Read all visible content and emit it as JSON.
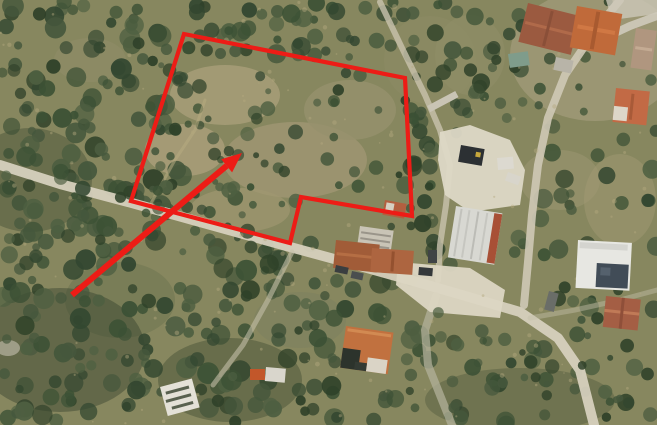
{
  "image": {
    "width": 657,
    "height": 425,
    "kind": "satellite-aerial-photo",
    "description": "Aerial satellite photograph of an olive-grove hillside at a village edge, with dirt roads, farm buildings and a warehouse; a red outline marks a land parcel and a red arrow points into it"
  },
  "annotation": {
    "color": "#ed1c16",
    "parcel_outline": {
      "points": [
        [
          184,
          34
        ],
        [
          405,
          78
        ],
        [
          412,
          216
        ],
        [
          301,
          197
        ],
        [
          290,
          243
        ],
        [
          131,
          201
        ]
      ],
      "stroke_width": 4.2
    },
    "arrow": {
      "tail": [
        72,
        295
      ],
      "tip": [
        242,
        153
      ],
      "shaft_width": 6,
      "head_length": 20,
      "head_half_width": 8.5
    }
  },
  "terrain": {
    "base": "#87875f",
    "washes": [
      [
        595,
        55,
        85,
        66,
        "#aca384",
        0.55
      ],
      [
        430,
        60,
        46,
        44,
        "#8e8c66",
        0.5
      ],
      [
        120,
        300,
        55,
        38,
        "#6f7752",
        0.6
      ],
      [
        520,
        400,
        95,
        32,
        "#39462f",
        0.3
      ],
      [
        60,
        350,
        85,
        62,
        "#2c3a27",
        0.4
      ],
      [
        30,
        180,
        62,
        52,
        "#31402b",
        0.35
      ],
      [
        230,
        380,
        72,
        42,
        "#2e3c28",
        0.35
      ],
      [
        8,
        348,
        12,
        8,
        "#c7c2b0",
        0.6
      ]
    ],
    "patches": [
      [
        225,
        95,
        55,
        30,
        "#a59c77",
        0.9
      ],
      [
        295,
        160,
        72,
        38,
        "#9f9572",
        0.85
      ],
      [
        185,
        150,
        40,
        26,
        "#ab9f7a",
        0.8
      ],
      [
        350,
        110,
        46,
        30,
        "#96916d",
        0.8
      ],
      [
        240,
        210,
        50,
        22,
        "#a09770",
        0.7
      ],
      [
        90,
        60,
        36,
        22,
        "#8f8c68",
        0.6
      ],
      [
        560,
        180,
        40,
        30,
        "#99956f",
        0.6
      ],
      [
        620,
        200,
        36,
        46,
        "#a29a74",
        0.5
      ],
      [
        300,
        320,
        46,
        28,
        "#7d815f",
        0.6
      ],
      [
        470,
        55,
        35,
        40,
        "#908d68",
        0.6
      ]
    ]
  },
  "trees": {
    "seed": 1337,
    "colors": [
      "#3c5135",
      "#334730",
      "#45573c",
      "#2f4129",
      "#4e5f41"
    ],
    "regions": [
      [
        0,
        0,
        195,
        425,
        210,
        4,
        11
      ],
      [
        180,
        0,
        240,
        55,
        45,
        4,
        10
      ],
      [
        150,
        45,
        265,
        200,
        62,
        3,
        8
      ],
      [
        185,
        240,
        240,
        185,
        125,
        4,
        11
      ],
      [
        405,
        125,
        252,
        300,
        135,
        4,
        10
      ],
      [
        408,
        0,
        115,
        135,
        42,
        4,
        9
      ],
      [
        515,
        0,
        142,
        135,
        18,
        3,
        6
      ]
    ],
    "overhang_regions": [
      [
        0,
        150,
        300,
        115,
        45,
        3,
        8
      ],
      [
        410,
        300,
        240,
        120,
        30,
        3,
        8
      ]
    ],
    "exclusions": [
      [
        438,
        122,
        100,
        100
      ],
      [
        392,
        255,
        155,
        70
      ],
      [
        570,
        232,
        80,
        65
      ],
      [
        448,
        198,
        62,
        68
      ],
      [
        328,
        232,
        96,
        48
      ],
      [
        525,
        0,
        132,
        50
      ],
      [
        336,
        318,
        66,
        60
      ],
      [
        598,
        290,
        52,
        45
      ],
      [
        152,
        382,
        48,
        40
      ]
    ],
    "speckles": {
      "count": 130,
      "color": "#b3a87e",
      "opacity": 0.45
    }
  },
  "roads": [
    {
      "name": "main-road",
      "points": [
        [
          0,
          165
        ],
        [
          60,
          184
        ],
        [
          128,
          202
        ],
        [
          200,
          222
        ],
        [
          290,
          247
        ],
        [
          360,
          266
        ],
        [
          410,
          280
        ],
        [
          462,
          295
        ],
        [
          520,
          312
        ],
        [
          558,
          338
        ],
        [
          580,
          370
        ],
        [
          594,
          425
        ]
      ],
      "width": 10,
      "color": "#d6d0bd",
      "opacity": 0.95
    },
    {
      "name": "village-road",
      "points": [
        [
          620,
          0
        ],
        [
          597,
          28
        ],
        [
          565,
          75
        ],
        [
          548,
          118
        ],
        [
          538,
          165
        ],
        [
          532,
          215
        ],
        [
          528,
          262
        ],
        [
          524,
          305
        ]
      ],
      "width": 8,
      "color": "#cfc9b6",
      "opacity": 0.9
    },
    {
      "name": "yard-track",
      "points": [
        [
          380,
          2
        ],
        [
          402,
          48
        ],
        [
          425,
          95
        ],
        [
          440,
          130
        ],
        [
          450,
          165
        ],
        [
          446,
          205
        ],
        [
          440,
          245
        ],
        [
          438,
          280
        ]
      ],
      "width": 6,
      "color": "#c9c3ae",
      "opacity": 0.8
    },
    {
      "name": "south-track",
      "points": [
        [
          436,
          296
        ],
        [
          425,
          330
        ],
        [
          428,
          365
        ],
        [
          442,
          400
        ],
        [
          452,
          425
        ]
      ],
      "width": 8,
      "color": "#b2b09a",
      "opacity": 0.75
    },
    {
      "name": "southwest-track",
      "points": [
        [
          292,
          252
        ],
        [
          268,
          300
        ],
        [
          243,
          345
        ],
        [
          213,
          385
        ]
      ],
      "width": 5,
      "color": "#c4bfa9",
      "opacity": 0.6
    },
    {
      "name": "east-track",
      "points": [
        [
          530,
          318
        ],
        [
          575,
          310
        ],
        [
          620,
          300
        ],
        [
          657,
          290
        ]
      ],
      "width": 5,
      "color": "#c4bfa9",
      "opacity": 0.45
    },
    {
      "name": "top-right-road",
      "points": [
        [
          600,
          40
        ],
        [
          630,
          26
        ],
        [
          657,
          16
        ]
      ],
      "width": 8,
      "color": "#cfcabb",
      "opacity": 0.9
    },
    {
      "name": "parcel-track",
      "points": [
        [
          150,
          205
        ],
        [
          175,
          160
        ],
        [
          195,
          130
        ],
        [
          205,
          100
        ]
      ],
      "width": 3,
      "color": "#b7ab80",
      "opacity": 0.55
    }
  ],
  "pads": [
    {
      "name": "junction-pad",
      "points": [
        [
          398,
          262
        ],
        [
          470,
          268
        ],
        [
          505,
          290
        ],
        [
          500,
          318
        ],
        [
          430,
          312
        ],
        [
          396,
          285
        ]
      ],
      "color": "#dcd6c3",
      "opacity": 0.95
    },
    {
      "name": "yard-pad",
      "points": [
        [
          440,
          132
        ],
        [
          470,
          125
        ],
        [
          510,
          140
        ],
        [
          525,
          170
        ],
        [
          520,
          205
        ],
        [
          470,
          212
        ],
        [
          445,
          195
        ],
        [
          438,
          160
        ]
      ],
      "color": "#ddd8c6",
      "opacity": 0.95
    },
    {
      "name": "corner-pad",
      "points": [
        [
          606,
          0
        ],
        [
          657,
          0
        ],
        [
          657,
          14
        ],
        [
          612,
          20
        ]
      ],
      "color": "#cdc8b9",
      "opacity": 0.8
    }
  ],
  "buildings": [
    {
      "name": "village-roof-1",
      "x": 528,
      "y": 3,
      "w": 54,
      "h": 40,
      "rot": 14,
      "fill": "#9b5a40",
      "parts": [
        [
          2,
          18,
          50,
          3,
          "#b06a4a",
          1
        ],
        [
          24,
          2,
          3,
          36,
          "#8a4f38",
          1
        ]
      ]
    },
    {
      "name": "village-roof-2",
      "x": 577,
      "y": 6,
      "w": 46,
      "h": 42,
      "rot": 10,
      "fill": "#c06a3a",
      "parts": [
        [
          4,
          18,
          38,
          4,
          "#d07844",
          1
        ],
        [
          20,
          2,
          4,
          38,
          "#a85a30",
          1
        ]
      ]
    },
    {
      "name": "village-roof-3",
      "x": 636,
      "y": 28,
      "w": 21,
      "h": 40,
      "rot": 8,
      "fill": "#b0967f",
      "parts": [
        [
          2,
          18,
          17,
          3,
          "#c4ab93",
          1
        ]
      ]
    },
    {
      "name": "village-house-4",
      "x": 616,
      "y": 88,
      "w": 34,
      "h": 34,
      "rot": 6,
      "fill": "#c26a45",
      "parts": [
        [
          0,
          18,
          14,
          14,
          "#ddd6c8",
          1
        ],
        [
          16,
          4,
          3,
          26,
          "#a85a38",
          1
        ]
      ]
    },
    {
      "name": "teal-shed",
      "x": 508,
      "y": 54,
      "w": 20,
      "h": 14,
      "rot": -8,
      "fill": "#7f9c8b",
      "parts": []
    },
    {
      "name": "grey-shed",
      "x": 556,
      "y": 57,
      "w": 18,
      "h": 13,
      "rot": 12,
      "fill": "#b8b4a8",
      "parts": []
    },
    {
      "name": "retaining-wall",
      "x": 427,
      "y": 106,
      "w": 32,
      "h": 7,
      "rot": -28,
      "fill": "#c9c4b4",
      "parts": []
    },
    {
      "name": "warehouse",
      "x": 456,
      "y": 206,
      "w": 47,
      "h": 52,
      "rot": 9,
      "fill": "#d8d8d2",
      "parts": [
        [
          5,
          2,
          2,
          48,
          "#c2c2bc",
          1
        ],
        [
          13,
          2,
          2,
          48,
          "#c6c6c0",
          1
        ],
        [
          22,
          2,
          2,
          48,
          "#bcbcb6",
          1
        ],
        [
          31,
          2,
          2,
          48,
          "#c6c6c0",
          1
        ],
        [
          39,
          1,
          8,
          50,
          "#a85036",
          1
        ]
      ]
    },
    {
      "name": "farm-structure-white",
      "x": 360,
      "y": 226,
      "w": 34,
      "h": 26,
      "rot": 8,
      "fill": "#c9c4b6",
      "parts": [
        [
          2,
          5,
          30,
          2,
          "#9a958a",
          1
        ],
        [
          2,
          11,
          30,
          2,
          "#9a958a",
          1
        ],
        [
          2,
          17,
          30,
          2,
          "#9a958a",
          1
        ]
      ]
    },
    {
      "name": "farm-roof-1",
      "x": 336,
      "y": 240,
      "w": 44,
      "h": 28,
      "rot": 6,
      "fill": "#a15c38",
      "parts": [
        [
          2,
          12,
          40,
          3,
          "#b56e44",
          1
        ]
      ]
    },
    {
      "name": "farm-roof-2",
      "x": 372,
      "y": 248,
      "w": 42,
      "h": 24,
      "rot": 4,
      "fill": "#ad6540",
      "parts": [
        [
          20,
          2,
          3,
          20,
          "#94512f",
          1
        ]
      ]
    },
    {
      "name": "notch-building",
      "x": 385,
      "y": 200,
      "w": 22,
      "h": 15,
      "rot": 10,
      "fill": "#b35f3f",
      "parts": [
        [
          2,
          2,
          8,
          11,
          "#d6d0c2",
          1
        ]
      ]
    },
    {
      "name": "bottom-house",
      "x": 346,
      "y": 326,
      "w": 48,
      "h": 42,
      "rot": 8,
      "fill": "#c1713f",
      "parts": [
        [
          2,
          2,
          44,
          3,
          "#d28a52",
          1
        ],
        [
          0,
          22,
          18,
          20,
          "#2c332c",
          1
        ],
        [
          26,
          28,
          20,
          14,
          "#dad4c6",
          1
        ],
        [
          14,
          34,
          12,
          8,
          "#333a33",
          1
        ]
      ]
    },
    {
      "name": "white-flat-building",
      "x": 578,
      "y": 240,
      "w": 54,
      "h": 48,
      "rot": 3,
      "fill": "#e7e7e2",
      "parts": [
        [
          2,
          2,
          48,
          6,
          "#d4d4cf",
          1
        ],
        [
          20,
          22,
          32,
          24,
          "#414c57",
          1
        ],
        [
          24,
          26,
          10,
          8,
          "#55616d",
          1
        ]
      ]
    },
    {
      "name": "terracotta-house",
      "x": 606,
      "y": 296,
      "w": 35,
      "h": 31,
      "rot": 6,
      "fill": "#a45e44",
      "parts": [
        [
          0,
          13,
          35,
          3,
          "#c07a57",
          1
        ],
        [
          16,
          0,
          3,
          31,
          "#8f4f39",
          1
        ]
      ]
    },
    {
      "name": "white-tent",
      "x": 160,
      "y": 387,
      "w": 33,
      "h": 30,
      "rot": -15,
      "fill": "#e4e1d7",
      "parts": [
        [
          4,
          6,
          24,
          3,
          "#59614f",
          1
        ],
        [
          2,
          14,
          26,
          3,
          "#59614f",
          1
        ],
        [
          6,
          22,
          22,
          3,
          "#59614f",
          1
        ]
      ]
    }
  ],
  "vehicles": [
    {
      "name": "dark-truck-yard",
      "x": 461,
      "y": 145,
      "w": 24,
      "h": 17,
      "rot": 10,
      "fill": "#2c3033",
      "parts": [
        [
          16,
          4,
          5,
          5,
          "#c8a83c",
          1
        ]
      ]
    },
    {
      "name": "white-machine-yard",
      "x": 497,
      "y": 158,
      "w": 16,
      "h": 12,
      "rot": -5,
      "fill": "#dcd9d0",
      "parts": []
    },
    {
      "name": "white-van-yard",
      "x": 508,
      "y": 172,
      "w": 14,
      "h": 9,
      "rot": 20,
      "fill": "#d8d5cb",
      "parts": []
    },
    {
      "name": "car-on-road-1",
      "x": 336,
      "y": 265,
      "w": 13,
      "h": 7,
      "rot": 12,
      "fill": "#3a3e40",
      "parts": []
    },
    {
      "name": "car-on-road-2",
      "x": 352,
      "y": 271,
      "w": 12,
      "h": 7,
      "rot": 12,
      "fill": "#4a4e4f",
      "parts": []
    },
    {
      "name": "car-on-road-3",
      "x": 419,
      "y": 267,
      "w": 14,
      "h": 8,
      "rot": 5,
      "fill": "#34383a",
      "parts": []
    },
    {
      "name": "car-on-road-4",
      "x": 428,
      "y": 250,
      "w": 9,
      "h": 13,
      "rot": 0,
      "fill": "#3f4345",
      "parts": []
    },
    {
      "name": "car-east-road",
      "x": 549,
      "y": 291,
      "w": 10,
      "h": 19,
      "rot": 15,
      "fill": "#6a6d68",
      "parts": []
    },
    {
      "name": "orange-digger",
      "x": 250,
      "y": 369,
      "w": 15,
      "h": 11,
      "rot": 0,
      "fill": "#c2572a",
      "parts": []
    },
    {
      "name": "white-truck-bottomleft",
      "x": 266,
      "y": 367,
      "w": 20,
      "h": 14,
      "rot": 5,
      "fill": "#d9d6cc",
      "parts": []
    }
  ]
}
